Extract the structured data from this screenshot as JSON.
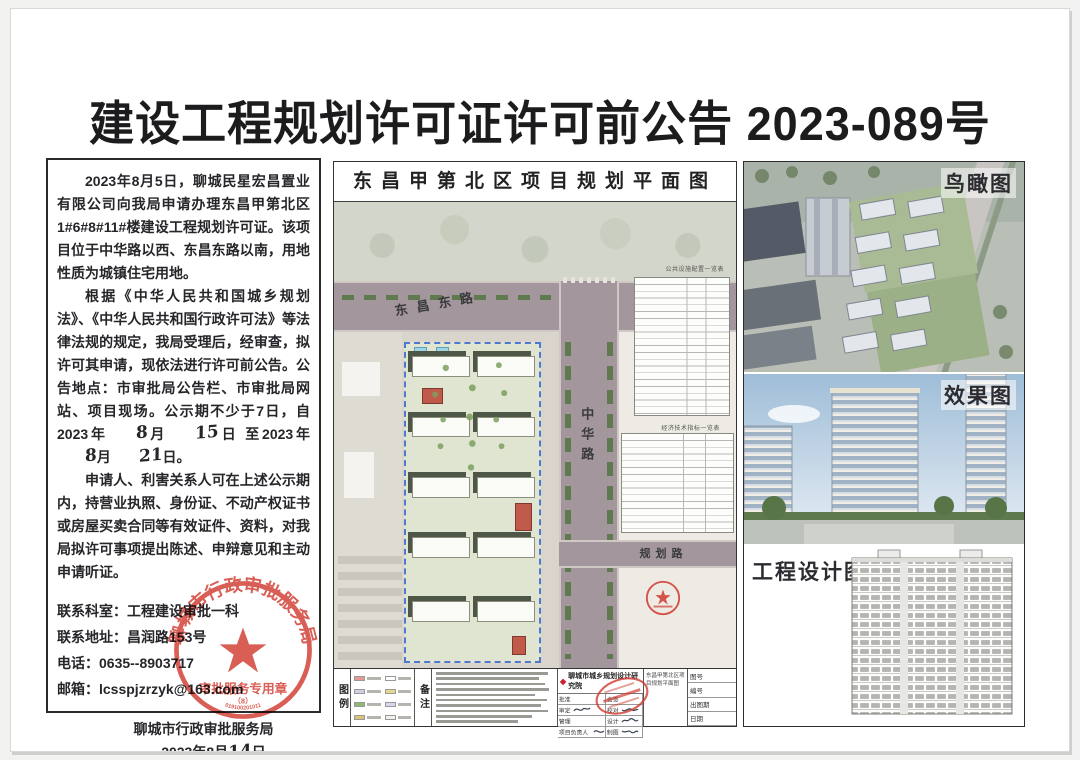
{
  "page": {
    "title": "建设工程规划许可证许可前公告 2023-089号"
  },
  "notice": {
    "p1": "2023年8月5日，聊城民星宏昌置业有限公司向我局申请办理东昌甲第北区1#6#8#11#楼建设工程规划许可证。该项目位于中华路以西、东昌东路以南，用地性质为城镇住宅用地。",
    "p2_pre": "根据《中华人民共和国城乡规划法》、《中华人民共和国行政许可法》等法律法规的规定，我局受理后，经审查，拟许可其申请，现依法进行许可前公告。公告地点：市审批局公告栏、市审批局网站、项目现场。公示期不少于7日，自2023年",
    "hw_month_from": "8",
    "seg1": "月",
    "hw_day_from": "15",
    "seg2": "日 至2023年",
    "hw_month_to": "8",
    "seg3": "月",
    "hw_day_to": "21",
    "seg4": "日。",
    "p3": "申请人、利害关系人可在上述公示期内，持营业执照、身份证、不动产权证书或房屋买卖合同等有效证件、资料，对我局拟许可事项提出陈述、申辩意见和主动申请听证。",
    "contacts": [
      "联系科室：工程建设审批一科",
      "联系地址：昌润路153号",
      "电话：0635--8903717",
      "邮箱：lcsspjzrzyk@163.com"
    ],
    "agency": "聊城市行政审批服务局",
    "date_pre": "2023年8月",
    "hw_sign_day": "14",
    "date_post": "日",
    "stamp": {
      "arc_text": "聊城市行政审批服务局",
      "bottom_text": "审批服务专用章",
      "sub_text": "（8）",
      "serial": "019100201011"
    }
  },
  "map": {
    "title": "东昌甲第北区项目规划平面图",
    "roads": {
      "east_road": "东昌东路",
      "zhonghua_road": "中华路",
      "planned_road": "规划路"
    },
    "table1_caption": "公共设施配置一览表",
    "table2_caption": "经济技术指标一览表",
    "legend_label": "图例",
    "notes_label": "备注",
    "institute": "聊城市城乡规划设计研究院",
    "titleblock": {
      "project": "东昌甲第北区项目规划平面图",
      "left_rows": [
        "批准",
        "审定",
        "管理",
        "项目负责人"
      ],
      "mid_rows": [
        "会签",
        "校对",
        "设计",
        "制图"
      ],
      "right_rows": [
        "图号",
        "编号",
        "出图期",
        "日期"
      ]
    }
  },
  "right_panels": {
    "birdseye_label": "鸟瞰图",
    "render_label": "效果图",
    "design_label": "工程设计图"
  },
  "colors": {
    "stamp_red": "#d03a30",
    "road_gray": "#a3969d",
    "parcel_green": "#e0e5d2",
    "parcel_border_blue": "#4f79cf",
    "accent_building_red": "#c05a4a"
  }
}
